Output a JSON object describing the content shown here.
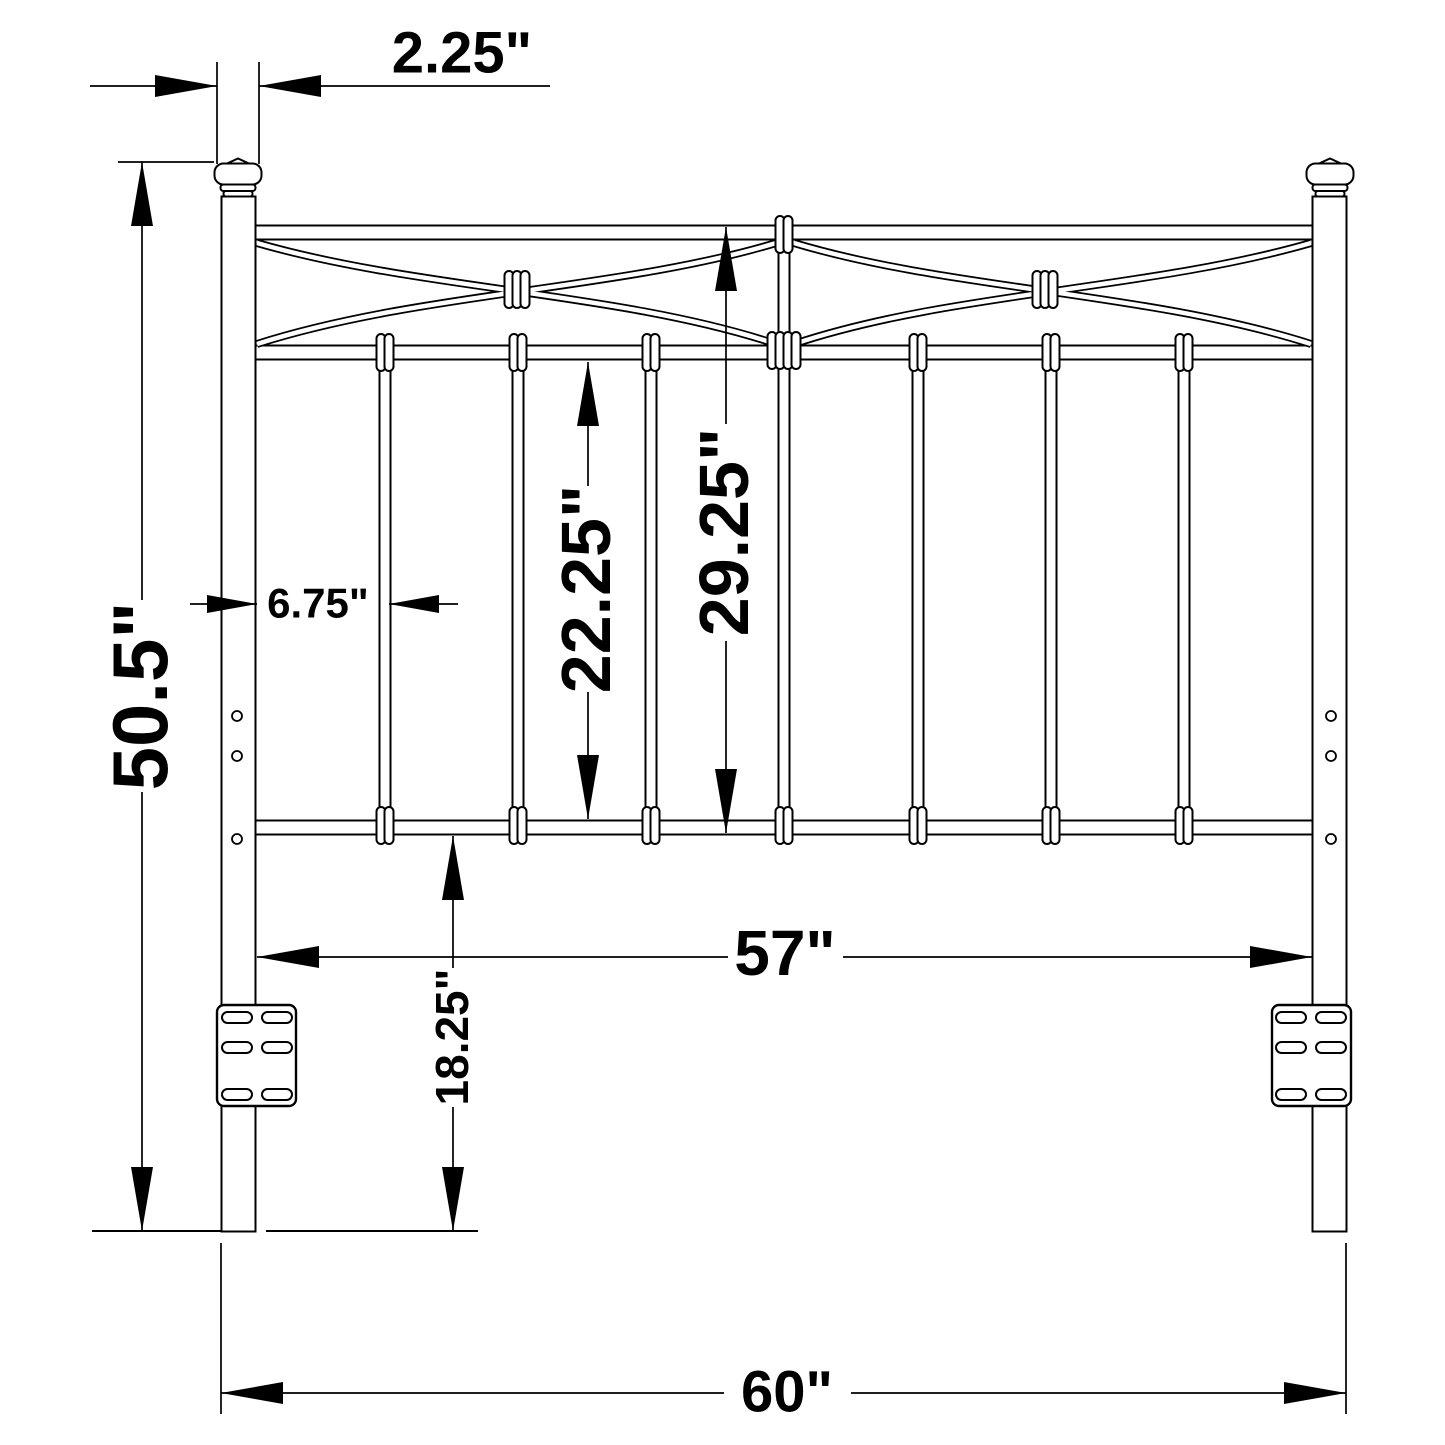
{
  "meta": {
    "drawing_type": "furniture dimension diagram",
    "subject": "metal headboard front view",
    "ink_color": "#000000",
    "background_color": "#ffffff"
  },
  "dimensions": {
    "post_width": {
      "label": "2.25\"",
      "inches": 2.25
    },
    "overall_height": {
      "label": "50.5\"",
      "inches": 50.5
    },
    "post_to_spindle": {
      "label": "6.75\"",
      "inches": 6.75
    },
    "spindle_section_height": {
      "label": "22.25\"",
      "inches": 22.25
    },
    "grill_height": {
      "label": "29.25\"",
      "inches": 29.25
    },
    "inner_width": {
      "label": "57\"",
      "inches": 57
    },
    "leg_height": {
      "label": "18.25\"",
      "inches": 18.25
    },
    "overall_width": {
      "label": "60\"",
      "inches": 60
    }
  },
  "structure": {
    "post_count": 2,
    "spindle_count": 7,
    "cross_band_count": 2,
    "mounting_bracket_count": 2,
    "bracket_slot_rows": 3,
    "bracket_slot_columns": 2,
    "post_hole_count": 3
  }
}
